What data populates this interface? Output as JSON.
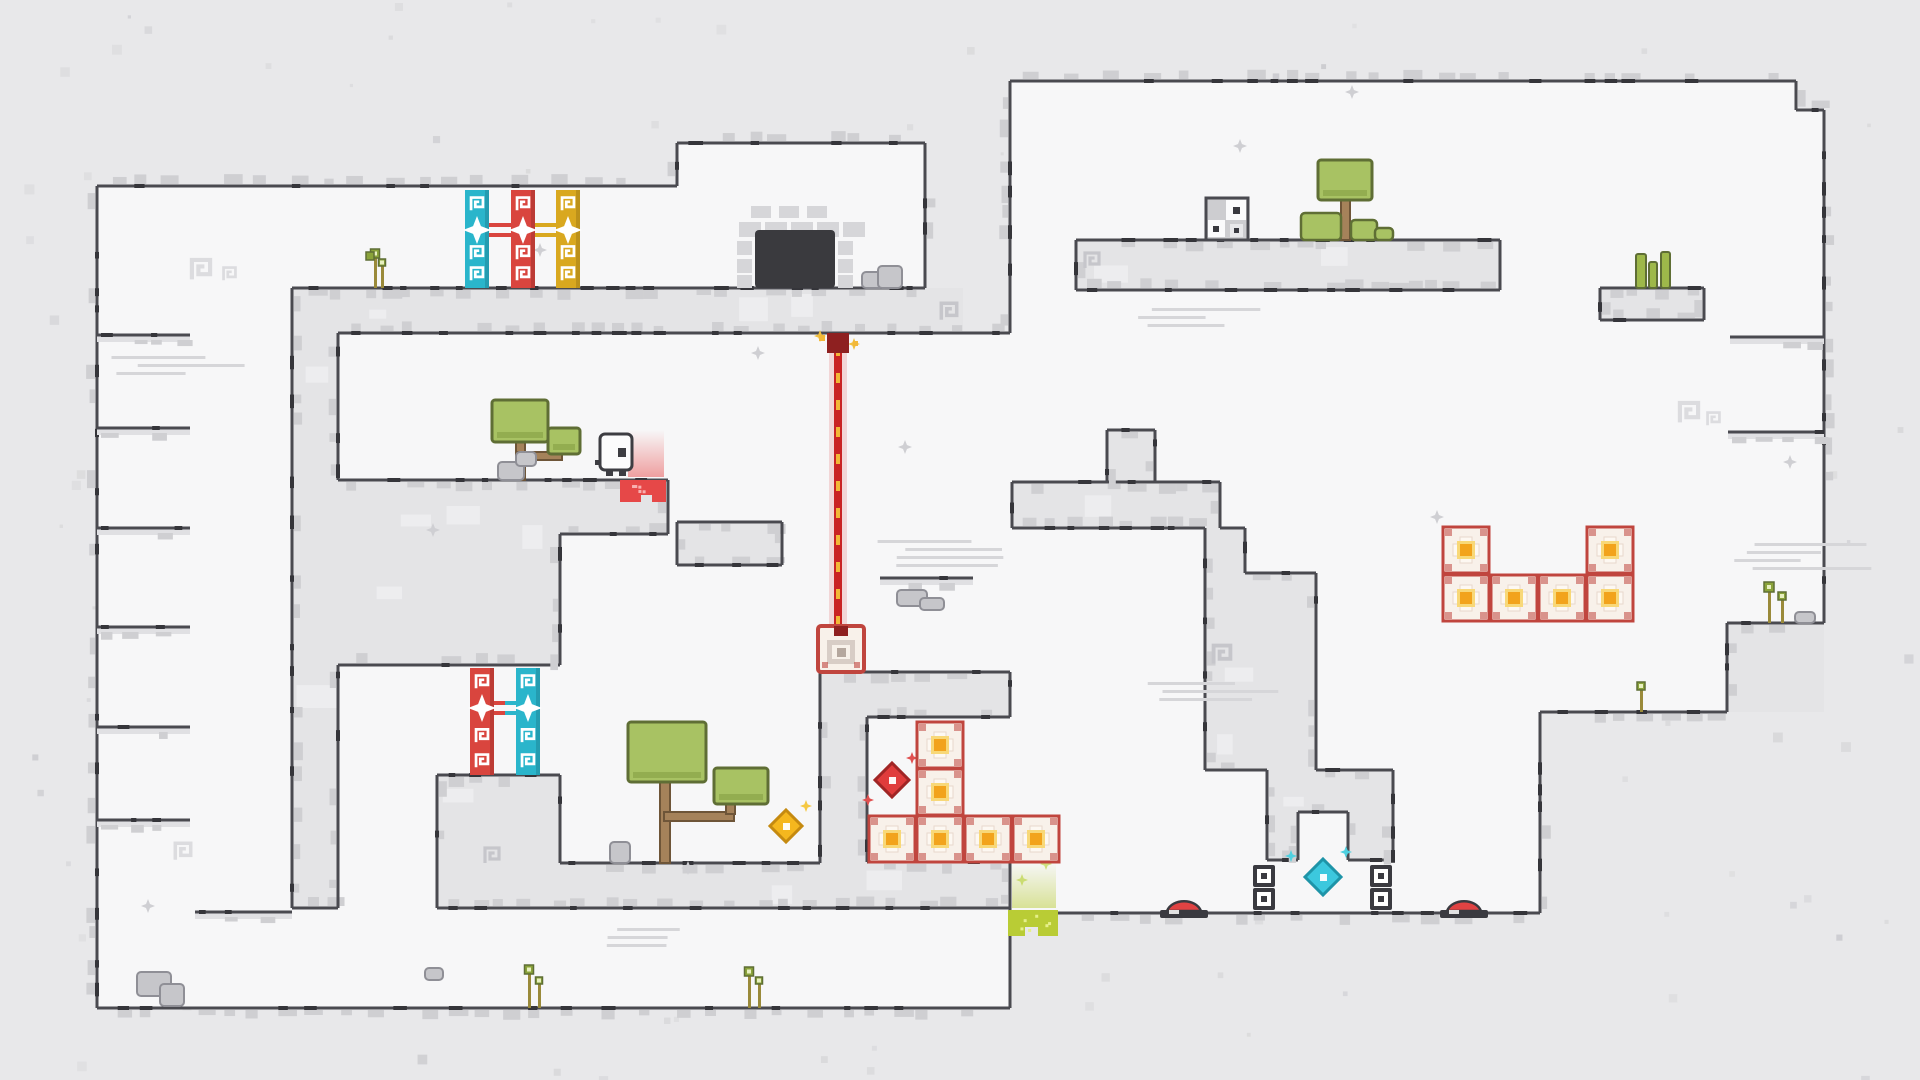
{
  "window": {
    "width": 1920,
    "height": 1080
  },
  "colors": {
    "outer": "#e8e8ea",
    "room": "#f7f7f8",
    "wall": "#e4e4e6",
    "wall_light": "#efeff1",
    "edge": "#4a4a50",
    "nub": "#35353a",
    "fringe": "#cfcfd2",
    "speckle": "#d8d8da",
    "cyan": "#2ab5cb",
    "red": "#d9453e",
    "yellow": "#d9a81f",
    "crate_border": "#c0453e",
    "crate_bg": "#f8f1ea",
    "crate_cream": "#fdf8f2",
    "crate_orange": "#f2a31c",
    "crate_glow": "#f8d878",
    "laser_core": "#c92424",
    "laser_glow": "#e98a8a",
    "laser_dash": "#f2b838",
    "emitter": "#8e2020",
    "door": "#3a3a3e",
    "brick": "#d6d6d9",
    "gem_red": "#e03c3c",
    "gem_red_dark": "#a02525",
    "gem_yellow": "#f5b71e",
    "gem_yellow_dark": "#c58a10",
    "gem_cyan": "#3cc8de",
    "gem_cyan_dark": "#1e94a8",
    "slime": "#b9cc35",
    "slime_light": "#e6f08a",
    "goo": "#e64848",
    "goo_light": "#f8b0b0",
    "button": "#e04343",
    "dark": "#3a3a40",
    "tree_green": "#a8c263",
    "tree_dark": "#5f6e35",
    "trunk": "#a5825a",
    "trunk_dark": "#6e5538",
    "plant_stem": "#9a8a3a",
    "plant_leaf": "#8aa33a",
    "rock": "#c6c6ca",
    "rock_dark": "#8f8f96",
    "spiral_white": "#dcdcdf",
    "spiral_wall": "#c6c6cb",
    "streak": "#d6d6d9",
    "sparkle": "#cfcfd3",
    "char_body": "#fcfcfc",
    "char_line": "#3d3d42"
  },
  "level": {
    "rooms": [
      [
        97,
        186,
        828,
        102
      ],
      [
        677,
        143,
        248,
        146
      ],
      [
        97,
        186,
        195,
        822
      ],
      [
        338,
        333,
        674,
        147
      ],
      [
        645,
        480,
        367,
        192
      ],
      [
        560,
        480,
        262,
        383
      ],
      [
        338,
        665,
        222,
        110
      ],
      [
        338,
        775,
        99,
        133
      ],
      [
        97,
        908,
        913,
        100
      ],
      [
        867,
        717,
        143,
        145
      ],
      [
        1010,
        528,
        530,
        385
      ],
      [
        1010,
        81,
        786,
        631
      ],
      [
        1796,
        110,
        28,
        513
      ]
    ],
    "walls": [
      [
        292,
        288,
        671,
        45
      ],
      [
        292,
        333,
        46,
        575
      ],
      [
        338,
        480,
        222,
        185
      ],
      [
        560,
        480,
        108,
        54
      ],
      [
        677,
        522,
        105,
        43
      ],
      [
        437,
        775,
        123,
        133
      ],
      [
        560,
        863,
        450,
        45
      ],
      [
        820,
        672,
        190,
        45
      ],
      [
        820,
        717,
        47,
        146
      ],
      [
        1012,
        482,
        208,
        46
      ],
      [
        1107,
        430,
        48,
        52
      ],
      [
        1205,
        528,
        40,
        45
      ],
      [
        1205,
        573,
        111,
        197
      ],
      [
        1267,
        770,
        126,
        90
      ],
      [
        1076,
        240,
        424,
        50
      ],
      [
        1600,
        288,
        104,
        32
      ],
      [
        1727,
        623,
        97,
        89
      ]
    ],
    "notches": [
      [
        1298,
        812,
        50,
        48
      ]
    ],
    "edges_h": [
      [
        97,
        186,
        677,
        "up"
      ],
      [
        677,
        143,
        925,
        "up"
      ],
      [
        292,
        288,
        925,
        "down"
      ],
      [
        338,
        333,
        1010,
        "up"
      ],
      [
        338,
        480,
        668,
        "down"
      ],
      [
        560,
        534,
        668,
        "up"
      ],
      [
        677,
        522,
        782,
        "down"
      ],
      [
        677,
        565,
        782,
        "up"
      ],
      [
        338,
        665,
        560,
        "up"
      ],
      [
        437,
        775,
        560,
        "down"
      ],
      [
        560,
        863,
        820,
        "down"
      ],
      [
        292,
        908,
        338,
        "up"
      ],
      [
        437,
        908,
        1010,
        "up"
      ],
      [
        97,
        1008,
        1010,
        "down"
      ],
      [
        1010,
        913,
        1540,
        "down"
      ],
      [
        1540,
        712,
        1727,
        "down"
      ],
      [
        1727,
        623,
        1824,
        "down"
      ],
      [
        1796,
        110,
        1824,
        "up"
      ],
      [
        1010,
        81,
        1796,
        "up"
      ],
      [
        820,
        672,
        1010,
        "down"
      ],
      [
        867,
        717,
        1010,
        "up"
      ],
      [
        867,
        862,
        1010,
        "down"
      ],
      [
        1012,
        482,
        1220,
        "down"
      ],
      [
        1012,
        528,
        1205,
        "up"
      ],
      [
        1107,
        430,
        1155,
        "down"
      ],
      [
        1220,
        528,
        1245,
        "down"
      ],
      [
        1245,
        573,
        1316,
        "down"
      ],
      [
        1205,
        770,
        1267,
        "up"
      ],
      [
        1316,
        770,
        1393,
        "down"
      ],
      [
        1267,
        860,
        1298,
        "up"
      ],
      [
        1298,
        812,
        1348,
        "up"
      ],
      [
        1348,
        860,
        1393,
        "up"
      ],
      [
        1076,
        240,
        1500,
        "down"
      ],
      [
        1076,
        290,
        1500,
        "up"
      ],
      [
        1600,
        288,
        1704,
        "down"
      ],
      [
        1600,
        320,
        1704,
        "up"
      ]
    ],
    "edges_v": [
      [
        677,
        143,
        186,
        "left"
      ],
      [
        925,
        143,
        288,
        "right"
      ],
      [
        292,
        288,
        908,
        "right"
      ],
      [
        338,
        333,
        480,
        "left"
      ],
      [
        338,
        665,
        908,
        "left"
      ],
      [
        560,
        534,
        665,
        "left"
      ],
      [
        668,
        480,
        534,
        "left"
      ],
      [
        677,
        522,
        565,
        "right"
      ],
      [
        782,
        522,
        565,
        "left"
      ],
      [
        437,
        775,
        908,
        "right"
      ],
      [
        560,
        775,
        863,
        "left"
      ],
      [
        820,
        672,
        863,
        "right"
      ],
      [
        867,
        717,
        862,
        "left"
      ],
      [
        1010,
        672,
        717,
        "left"
      ],
      [
        1010,
        862,
        908,
        "left"
      ],
      [
        1010,
        908,
        1008,
        "right"
      ],
      [
        1540,
        712,
        913,
        "right"
      ],
      [
        1727,
        623,
        712,
        "right"
      ],
      [
        1824,
        110,
        623,
        "right"
      ],
      [
        1796,
        81,
        110,
        "right"
      ],
      [
        1010,
        81,
        333,
        "left"
      ],
      [
        1012,
        482,
        528,
        "right"
      ],
      [
        1220,
        482,
        528,
        "left"
      ],
      [
        1107,
        430,
        482,
        "right"
      ],
      [
        1155,
        430,
        482,
        "left"
      ],
      [
        1205,
        528,
        573,
        "right"
      ],
      [
        1245,
        528,
        573,
        "left"
      ],
      [
        1205,
        573,
        770,
        "right"
      ],
      [
        1316,
        573,
        770,
        "left"
      ],
      [
        1267,
        770,
        860,
        "right"
      ],
      [
        1393,
        770,
        860,
        "left"
      ],
      [
        1298,
        812,
        860,
        "left"
      ],
      [
        1348,
        812,
        860,
        "right"
      ],
      [
        97,
        186,
        1008,
        "left"
      ],
      [
        1076,
        240,
        290,
        "right"
      ],
      [
        1500,
        240,
        290,
        "left"
      ],
      [
        1600,
        288,
        320,
        "right"
      ],
      [
        1704,
        288,
        320,
        "left"
      ]
    ],
    "ledges": [
      [
        97,
        335,
        93
      ],
      [
        97,
        428,
        93
      ],
      [
        97,
        528,
        93
      ],
      [
        97,
        627,
        93
      ],
      [
        97,
        727,
        93
      ],
      [
        97,
        820,
        93
      ],
      [
        1730,
        337,
        94
      ],
      [
        1728,
        432,
        96
      ],
      [
        880,
        578,
        93
      ],
      [
        195,
        912,
        97
      ]
    ],
    "spirals_white": [
      [
        188,
        256,
        26
      ],
      [
        221,
        265,
        17
      ],
      [
        1676,
        399,
        26
      ],
      [
        1705,
        410,
        17
      ],
      [
        172,
        840,
        22
      ]
    ],
    "spirals_wall": [
      [
        938,
        300,
        22
      ],
      [
        1210,
        642,
        24
      ],
      [
        482,
        845,
        20
      ],
      [
        1082,
        250,
        20
      ]
    ],
    "streaks": [
      [
        112,
        356,
        3
      ],
      [
        880,
        540,
        4
      ],
      [
        1737,
        543,
        4
      ],
      [
        1150,
        682,
        3
      ],
      [
        590,
        928,
        3
      ],
      [
        1124,
        308,
        3
      ]
    ],
    "sparkles": [
      [
        433,
        530
      ],
      [
        905,
        447
      ],
      [
        1240,
        146
      ],
      [
        1437,
        517
      ],
      [
        688,
        868
      ],
      [
        148,
        906
      ],
      [
        1790,
        462
      ],
      [
        758,
        353
      ],
      [
        1352,
        92
      ],
      [
        540,
        250
      ]
    ],
    "sparkles_colored": [
      [
        806,
        806,
        "#f5c842"
      ],
      [
        912,
        758,
        "#e05050"
      ],
      [
        868,
        800,
        "#e05050"
      ],
      [
        1346,
        852,
        "#4fd0e0"
      ],
      [
        1291,
        856,
        "#4fd0e0"
      ],
      [
        1022,
        880,
        "#cfe080"
      ],
      [
        1046,
        864,
        "#cfe080"
      ],
      [
        820,
        336,
        "#f0c040"
      ],
      [
        854,
        344,
        "#f0c040"
      ]
    ]
  },
  "entities": {
    "gates": [
      {
        "id": "gate-cyan-top",
        "color": "cyan",
        "x": 465,
        "y": 190,
        "w": 24,
        "h": 98,
        "lock_cy": 230
      },
      {
        "id": "gate-red-top",
        "color": "red",
        "x": 511,
        "y": 190,
        "w": 24,
        "h": 98,
        "lock_cy": 230
      },
      {
        "id": "gate-yellow-top",
        "color": "yellow",
        "x": 556,
        "y": 190,
        "w": 24,
        "h": 98,
        "lock_cy": 230
      },
      {
        "id": "gate-red-bottom",
        "color": "red",
        "x": 470,
        "y": 668,
        "w": 24,
        "h": 107,
        "lock_cy": 708
      },
      {
        "id": "gate-cyan-bottom",
        "color": "cyan",
        "x": 516,
        "y": 668,
        "w": 24,
        "h": 107,
        "lock_cy": 708
      }
    ],
    "gate_links": [
      [
        489,
        511,
        230,
        "red",
        "red"
      ],
      [
        535,
        556,
        230,
        "yellow",
        "yellow"
      ],
      [
        494,
        516,
        708,
        "red",
        "cyan"
      ]
    ],
    "door": {
      "x": 755,
      "y": 230,
      "w": 80,
      "h": 58
    },
    "bricks": [
      [
        751,
        206,
        20,
        12
      ],
      [
        779,
        206,
        20,
        12
      ],
      [
        807,
        206,
        20,
        12
      ],
      [
        739,
        222,
        22,
        15
      ],
      [
        765,
        222,
        22,
        15
      ],
      [
        791,
        222,
        22,
        15
      ],
      [
        817,
        222,
        22,
        15
      ],
      [
        843,
        222,
        22,
        15
      ],
      [
        737,
        241,
        15,
        14
      ],
      [
        737,
        259,
        15,
        14
      ],
      [
        737,
        275,
        15,
        13
      ],
      [
        838,
        241,
        15,
        14
      ],
      [
        838,
        259,
        15,
        14
      ],
      [
        838,
        275,
        15,
        13
      ]
    ],
    "player": {
      "x": 600,
      "y": 434,
      "w": 32,
      "h": 36
    },
    "laser": {
      "x": 838,
      "y1": 336,
      "y2": 626,
      "emitter": [
        827,
        333,
        22,
        20
      ]
    },
    "receiver": {
      "x": 818,
      "y": 626,
      "w": 46,
      "h": 46
    },
    "crates": {
      "size": 46,
      "positions": [
        [
          1443,
          527
        ],
        [
          1587,
          527
        ],
        [
          1443,
          575
        ],
        [
          1491,
          575
        ],
        [
          1539,
          575
        ],
        [
          1587,
          575
        ],
        [
          917,
          722
        ],
        [
          917,
          769
        ],
        [
          869,
          816
        ],
        [
          917,
          816
        ],
        [
          965,
          816
        ],
        [
          1013,
          816
        ]
      ]
    },
    "gems": [
      {
        "id": "gem-red",
        "cx": 892,
        "cy": 780,
        "r": 17,
        "fill": "gem_red",
        "stroke": "gem_red_dark"
      },
      {
        "id": "gem-yellow",
        "cx": 786,
        "cy": 826,
        "r": 16,
        "fill": "gem_yellow",
        "stroke": "gem_yellow_dark"
      },
      {
        "id": "gem-cyan",
        "cx": 1323,
        "cy": 877,
        "r": 18,
        "fill": "gem_cyan",
        "stroke": "gem_cyan_dark"
      }
    ],
    "buttons": [
      [
        1163,
        905
      ],
      [
        1443,
        905
      ]
    ],
    "sockets": [
      [
        1253,
        865
      ],
      [
        1253,
        888
      ],
      [
        1370,
        865
      ],
      [
        1370,
        888
      ]
    ],
    "slime": {
      "x": 1008,
      "y": 908
    },
    "red_goo": {
      "x": 620,
      "y": 477
    },
    "dice_block": {
      "x": 1206,
      "y": 198,
      "s": 42
    },
    "trees": [
      {
        "id": "tree-island",
        "canopies": [
          [
            1318,
            160,
            54,
            40
          ]
        ],
        "trunk": [
          [
            1341,
            200,
            9,
            40
          ]
        ]
      },
      {
        "id": "tree-small",
        "canopies": [
          [
            492,
            400,
            56,
            42
          ],
          [
            548,
            428,
            32,
            26
          ]
        ],
        "trunk": [
          [
            516,
            440,
            9,
            40
          ],
          [
            516,
            452,
            46,
            8
          ]
        ]
      },
      {
        "id": "tree-big",
        "canopies": [
          [
            628,
            722,
            78,
            60
          ],
          [
            714,
            768,
            54,
            36
          ]
        ],
        "trunk": [
          [
            660,
            780,
            10,
            83
          ],
          [
            664,
            812,
            70,
            9
          ],
          [
            726,
            800,
            9,
            14
          ]
        ]
      }
    ],
    "bushes": [
      [
        1301,
        213,
        40,
        27
      ],
      [
        1351,
        220,
        26,
        20
      ],
      [
        1375,
        228,
        18,
        12
      ]
    ],
    "plants": [
      {
        "x": 370,
        "stems": [
          [
            374,
            258,
            288,
            9
          ],
          [
            381,
            266,
            288,
            7
          ]
        ]
      },
      {
        "x": 528,
        "stems": [
          [
            528,
            974,
            1008,
            9
          ],
          [
            538,
            984,
            1008,
            7
          ]
        ]
      },
      {
        "x": 748,
        "stems": [
          [
            748,
            976,
            1008,
            9
          ],
          [
            758,
            984,
            1008,
            7
          ]
        ]
      },
      {
        "x": 1768,
        "stems": [
          [
            1768,
            592,
            623,
            10
          ],
          [
            1781,
            600,
            623,
            8
          ]
        ]
      },
      {
        "x": 1640,
        "stems": [
          [
            1640,
            690,
            712,
            8
          ]
        ]
      }
    ],
    "cactus": [
      [
        1636,
        254,
        10,
        34
      ],
      [
        1649,
        262,
        8,
        26
      ],
      [
        1661,
        252,
        9,
        36
      ]
    ],
    "rocks": [
      [
        862,
        272,
        22,
        16
      ],
      [
        878,
        266,
        24,
        22
      ],
      [
        610,
        842,
        20,
        21
      ],
      [
        498,
        462,
        26,
        18
      ],
      [
        516,
        452,
        20,
        14
      ],
      [
        137,
        972,
        34,
        24
      ],
      [
        160,
        984,
        24,
        22
      ],
      [
        1795,
        612,
        20,
        11
      ],
      [
        897,
        590,
        30,
        16
      ],
      [
        920,
        598,
        24,
        12
      ],
      [
        425,
        968,
        18,
        12
      ]
    ]
  }
}
